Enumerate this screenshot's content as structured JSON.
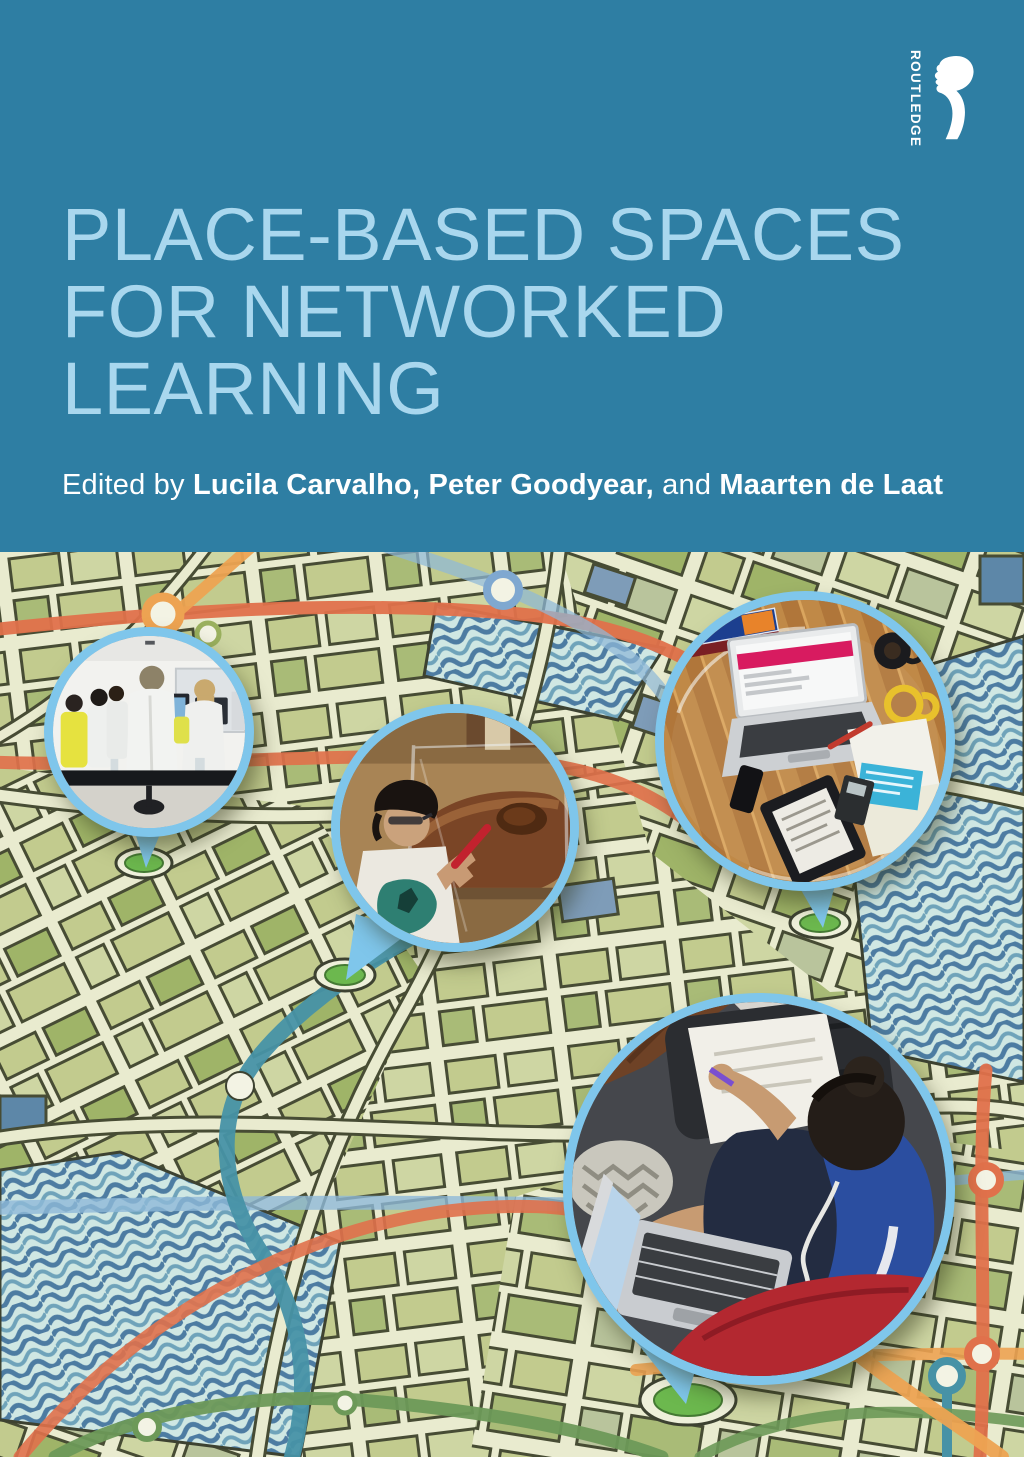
{
  "publisher": {
    "wordmark": "ROUTLEDGE",
    "mark_icon": "routledge-r-profile-monogram"
  },
  "title": {
    "line1": "PLACE-BASED SPACES",
    "line2": "FOR NETWORKED",
    "line3": "LEARNING"
  },
  "byline": {
    "prefix": "Edited by ",
    "editor1": "Lucila Carvalho, ",
    "editor2": "Peter Goodyear, ",
    "conjunction": "and ",
    "editor3": "Maarten de Laat"
  },
  "photos": {
    "lab": "students-working-at-computers-in-lab",
    "museum": "boy-with-red-stylus-at-museum-exhibit",
    "desk": "overhead-desk-laptop-tablet-coffee-papers",
    "couch": "teen-on-couch-with-laptop-notes-headphones"
  },
  "colors": {
    "band_teal": "#2e7ea3",
    "title_blue": "#a9d7ee",
    "byline_white": "#ffffff",
    "circle_border_blue": "#7fc6eb",
    "map_cream": "#e9ebcf",
    "map_outline": "#474c34",
    "pin_green": "#6cb84e",
    "water_wave_blue": "#4d7ca2",
    "transit_orange": "#eda352",
    "transit_red_orange": "#e0714b",
    "transit_teal": "#4792a6",
    "transit_green": "#6d9958",
    "transit_blue": "#8fb9d8"
  }
}
